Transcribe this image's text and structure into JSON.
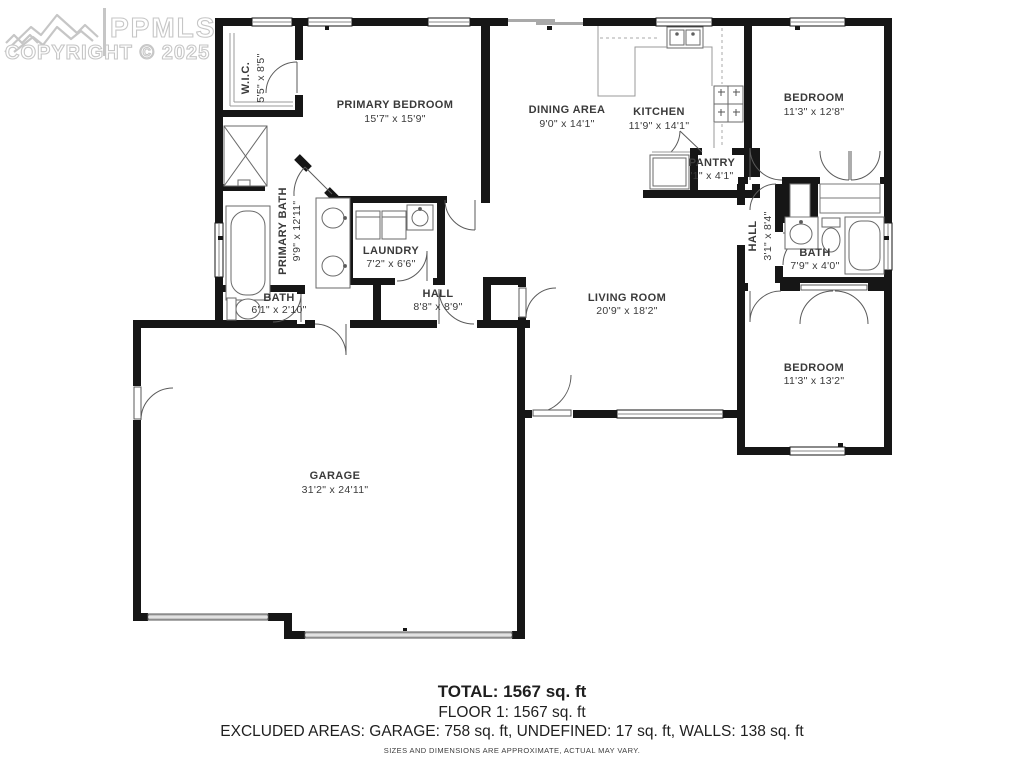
{
  "watermark": {
    "brand": "PPMLS",
    "copyright": "COPYRIGHT © 2025"
  },
  "rooms": [
    {
      "name": "W.I.C.",
      "dims": "5'5\" x 8'5\""
    },
    {
      "name": "PRIMARY BEDROOM",
      "dims": "15'7\" x 15'9\""
    },
    {
      "name": "DINING AREA",
      "dims": "9'0\" x 14'1\""
    },
    {
      "name": "KITCHEN",
      "dims": "11'9\" x 14'1\""
    },
    {
      "name": "BEDROOM",
      "dims": "11'3\" x 12'8\""
    },
    {
      "name": "PANTRY",
      "dims": "'1\" x 4'1\""
    },
    {
      "name": "HALL",
      "dims": "3'1\" x 8'4\""
    },
    {
      "name": "BATH",
      "dims": "7'9\" x 4'0\""
    },
    {
      "name": "PRIMARY BATH",
      "dims": "9'9\" x 12'11\""
    },
    {
      "name": "LAUNDRY",
      "dims": "7'2\" x 6'6\""
    },
    {
      "name": "BATH",
      "dims": "6'1\" x 2'10\""
    },
    {
      "name": "HALL",
      "dims": "8'8\" x 8'9\""
    },
    {
      "name": "LIVING ROOM",
      "dims": "20'9\" x 18'2\""
    },
    {
      "name": "BEDROOM",
      "dims": "11'3\" x 13'2\""
    },
    {
      "name": "GARAGE",
      "dims": "31'2\" x 24'11\""
    }
  ],
  "footer": {
    "total": "TOTAL: 1567 sq. ft",
    "floor": "FLOOR 1: 1567 sq. ft",
    "excluded": "EXCLUDED AREAS: GARAGE: 758 sq. ft, UNDEFINED: 17 sq. ft, WALLS: 138 sq. ft",
    "disclaimer": "SIZES AND DIMENSIONS ARE APPROXIMATE, ACTUAL MAY VARY."
  },
  "colors": {
    "wall": "#161616",
    "label": "#3a3a3a",
    "watermark": "#c6c6c6",
    "fixture": "#555555"
  }
}
